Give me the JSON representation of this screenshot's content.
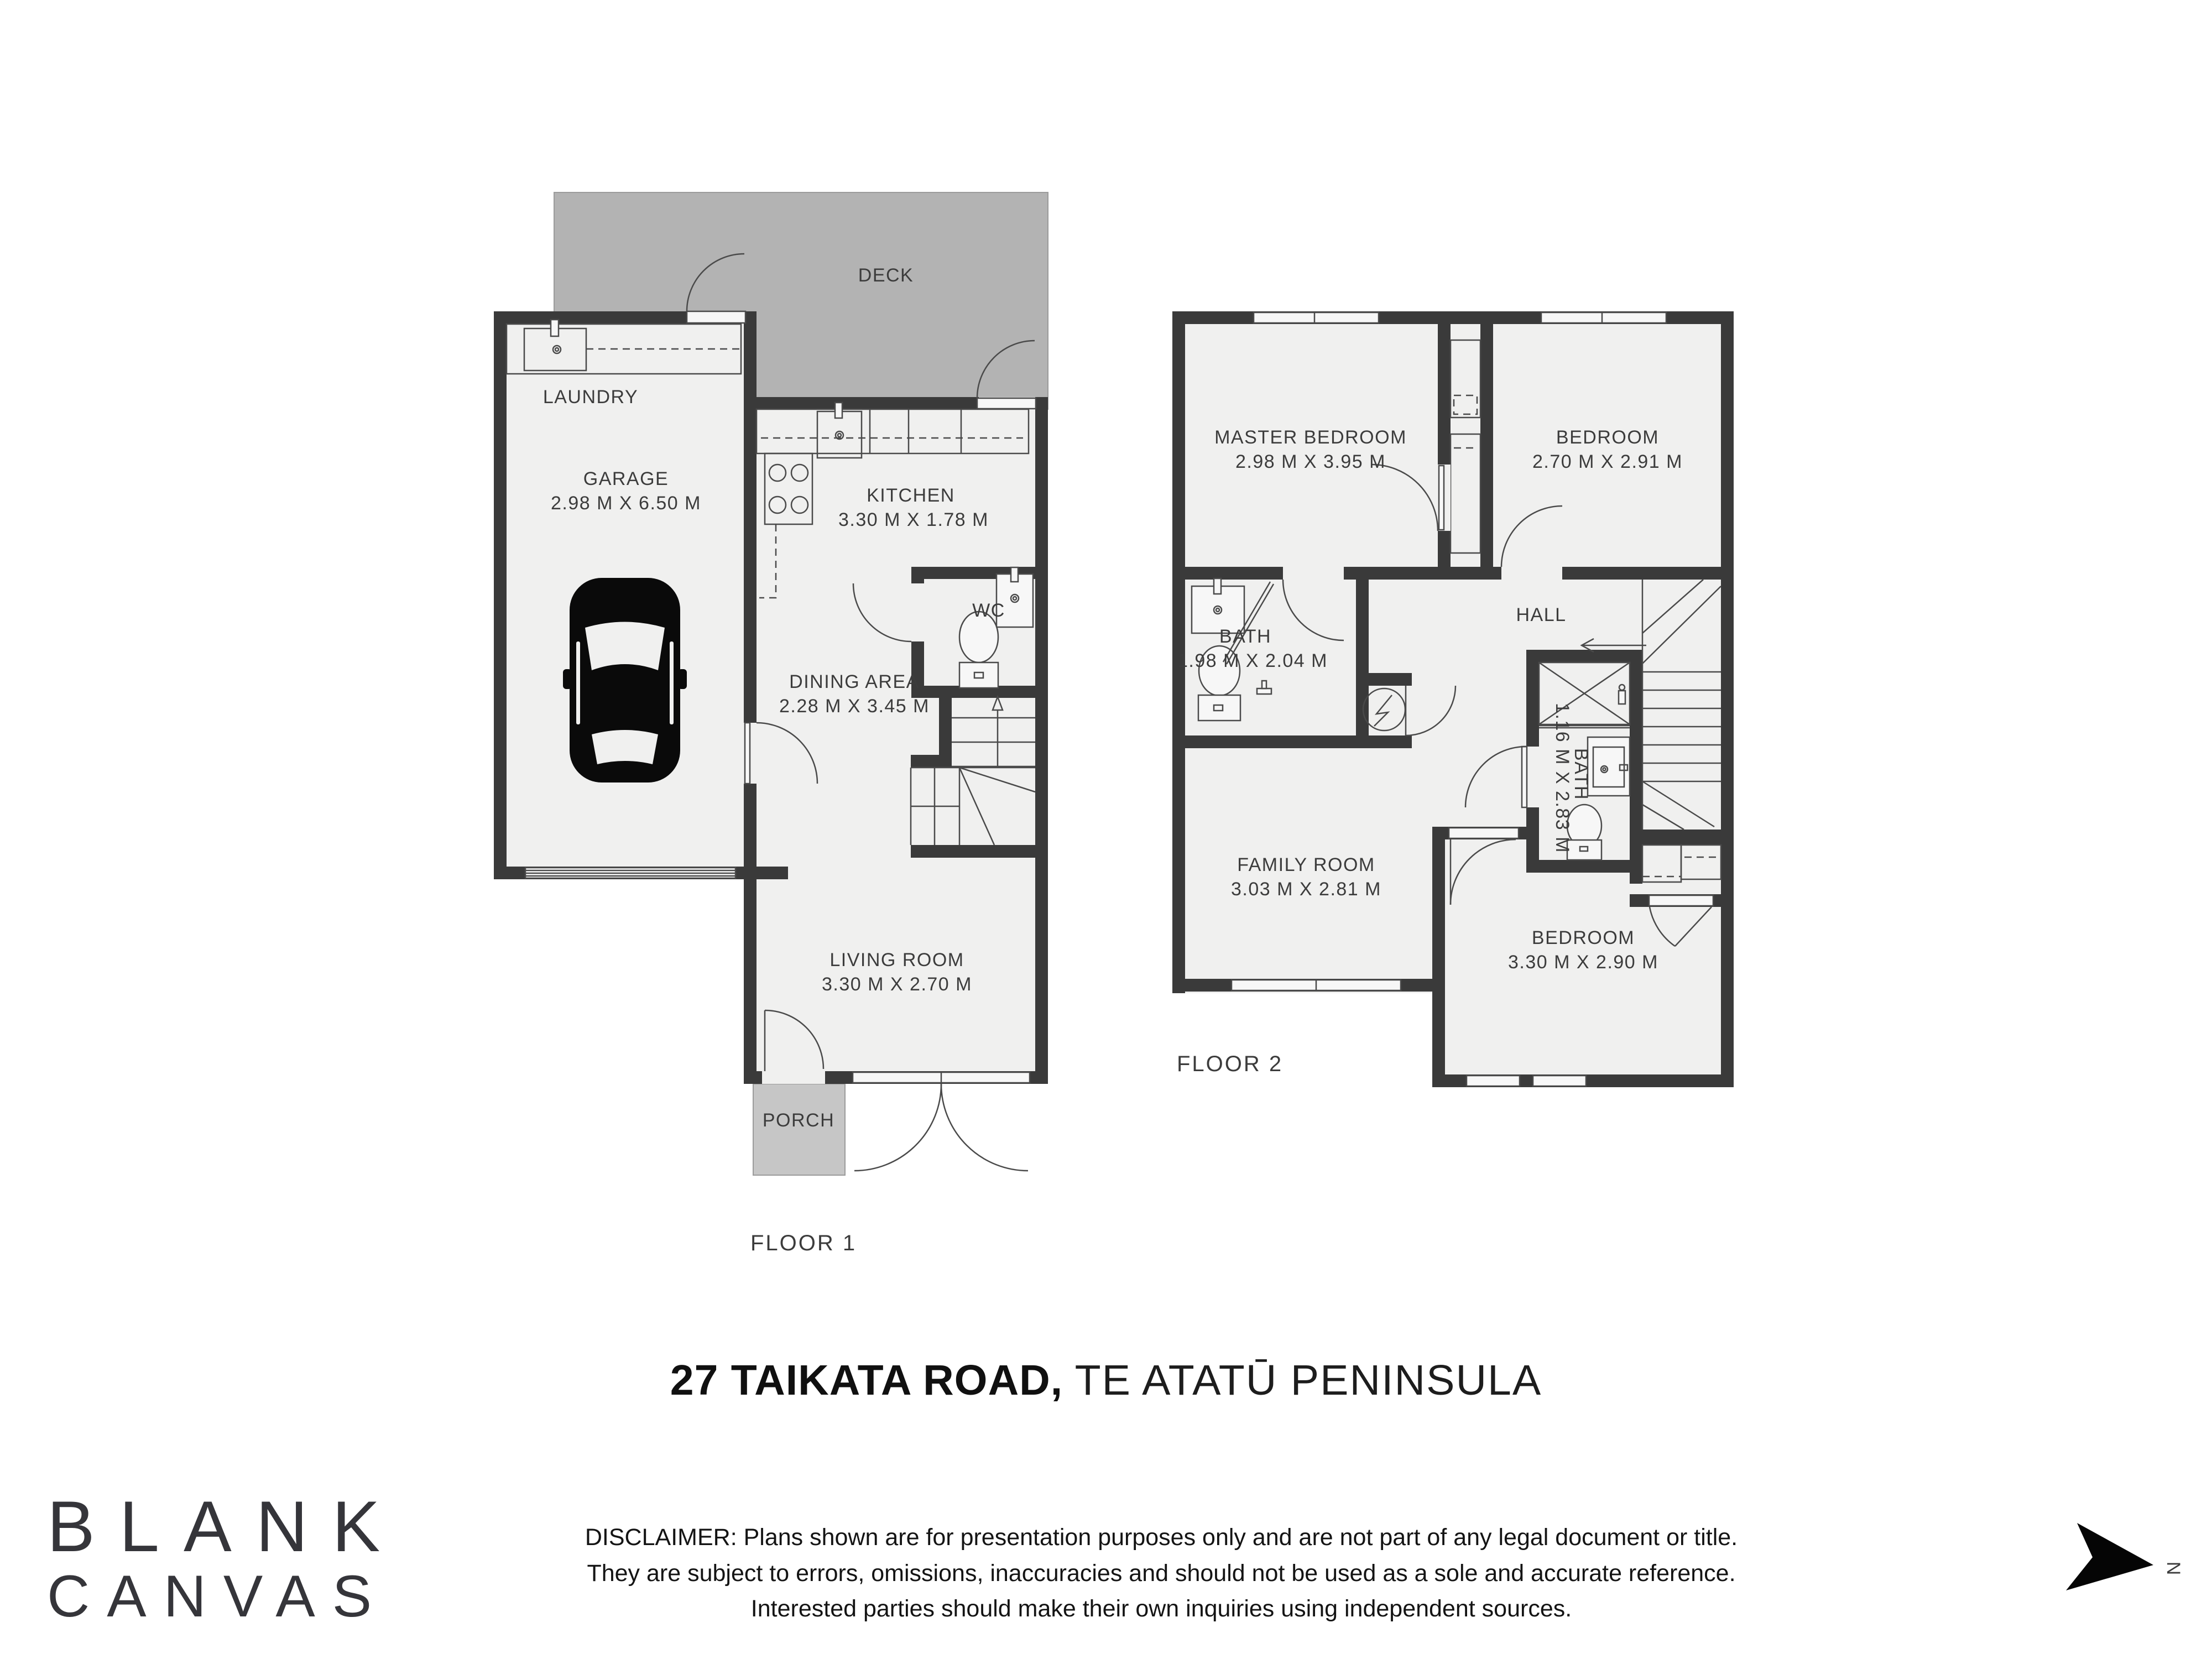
{
  "title": {
    "address_bold": "27 TAIKATA ROAD,",
    "address_light": "TE ATATŪ PENINSULA"
  },
  "floor1": {
    "label": "FLOOR 1",
    "rooms": {
      "deck": {
        "label": "DECK"
      },
      "laundry": {
        "label": "LAUNDRY"
      },
      "garage": {
        "label": "GARAGE",
        "dims": "2.98 M X 6.50 M"
      },
      "kitchen": {
        "label": "KITCHEN",
        "dims": "3.30 M X 1.78 M"
      },
      "wc": {
        "label": "WC"
      },
      "dining": {
        "label": "DINING AREA",
        "dims": "2.28 M X 3.45 M"
      },
      "living": {
        "label": "LIVING ROOM",
        "dims": "3.30 M X 2.70 M"
      },
      "porch": {
        "label": "PORCH"
      }
    }
  },
  "floor2": {
    "label": "FLOOR 2",
    "rooms": {
      "master_bedroom": {
        "label": "MASTER BEDROOM",
        "dims": "2.98 M X 3.95 M"
      },
      "bedroom_top": {
        "label": "BEDROOM",
        "dims": "2.70 M X 2.91 M"
      },
      "bath_main": {
        "label": "BATH",
        "dims": "1.98 M X 2.04 M"
      },
      "hall": {
        "label": "HALL"
      },
      "bath_small": {
        "label": "BATH",
        "dims": "1.16 M X 2.83 M"
      },
      "family_room": {
        "label": "FAMILY ROOM",
        "dims": "3.03 M X 2.81 M"
      },
      "bedroom_bottom": {
        "label": "BEDROOM",
        "dims": "3.30 M X 2.90 M"
      }
    }
  },
  "logo": {
    "line1": "BLANK",
    "line2": "CANVAS"
  },
  "north": {
    "label": "N"
  },
  "disclaimer": {
    "line1": "DISCLAIMER: Plans shown are for presentation purposes only and are not part of any legal document or title.",
    "line2": "They are subject to errors, omissions, inaccuracies and should not be used as a sole and accurate reference.",
    "line3": "Interested parties should make their own inquiries using independent sources."
  },
  "colors": {
    "wall": "#3a3a3a",
    "room_fill": "#f0f0ef",
    "deck_fill": "#b3b3b3",
    "porch_fill": "#c6c6c6",
    "line": "#4a4a4a",
    "label_text": "#3c3c3c"
  }
}
